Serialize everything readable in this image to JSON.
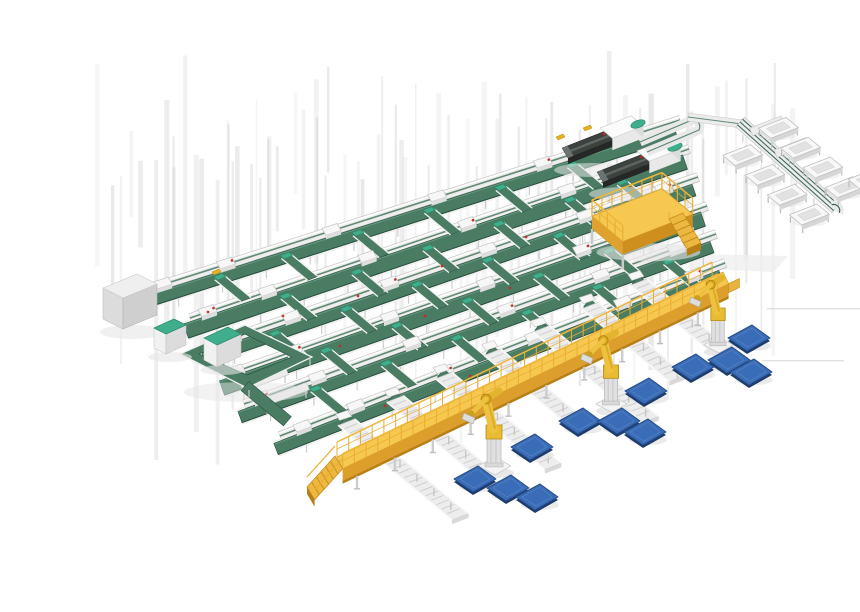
{
  "meta": {
    "description": "3D isometric render of an automated parcel sortation and palletizing system: grid of green belt sorter conveyors, two dark telescopic unloaders, a spur line with white trough bins, a yellow maintenance platform, an elevated yellow walkway with stairs, three yellow palletizing robots and scattered blue pallets.",
    "width": 860,
    "height": 580
  },
  "palette": {
    "bg": "#ffffff",
    "streak": "#cccccc",
    "streak_dark": "#bdbdbd",
    "frame": "#ececec",
    "frame_edge": "#c6c6c6",
    "frame_hi": "#ffffff",
    "frame_mid": "#dcdcdc",
    "leg": "#c2c2c2",
    "belt": "#4a7c64",
    "belt_dark": "#2e5947",
    "belt_line": "#49795f",
    "belt_hi": "#6a9a82",
    "teal": "#3fae8c",
    "teal_dark": "#2d8a6c",
    "machine_dark": "#3d423f",
    "machine_darker": "#242826",
    "machine_stripe": "#5d6663",
    "cabinet_top": "#efefef",
    "cabinet_front": "#dcdcdc",
    "cabinet_side": "#cfcfcf",
    "yellow": "#f6c84f",
    "yellow_mid": "#e0a22e",
    "yellow_dark": "#cf8f1f",
    "yellow_deep": "#b97f15",
    "rail": "#e9ac2f",
    "stair": "#edb83f",
    "robot": "#eec23f",
    "robot_dark": "#d9a51e",
    "robot_line": "#b68c15",
    "pedestal": "#e0e0e0",
    "pallet": "#3a6db8",
    "pallet_edge": "#274c88",
    "pallet_side": "#1d3c6e",
    "pallet_hi": "#5d86c2",
    "red": "#c9271b",
    "accent_yellow": "#e8b020",
    "shadow": "#e6e6e6",
    "white": "#f7f7f7"
  },
  "iso": {
    "u": [
      0.92,
      -0.36
    ],
    "v": [
      0.77,
      0.64
    ]
  },
  "streaks": {
    "x0": 58,
    "x1": 748,
    "count": 66,
    "y_top": 34,
    "extra_dark": 14
  },
  "grid": {
    "lanes": [
      {
        "s": [
          112,
          272
        ],
        "e": [
          640,
          104
        ]
      },
      {
        "s": [
          150,
          302
        ],
        "e": [
          649,
          133
        ]
      },
      {
        "s": [
          168,
          330
        ],
        "e": [
          658,
          161
        ]
      },
      {
        "s": [
          186,
          359
        ],
        "e": [
          667,
          190
        ]
      },
      {
        "s": [
          204,
          388
        ],
        "e": [
          676,
          218
        ]
      },
      {
        "s": [
          240,
          420
        ],
        "e": [
          685,
          247
        ]
      }
    ],
    "band_offset": [
      -4,
      13
    ],
    "machine_fracs": [
      0.14,
      0.34,
      0.54,
      0.74,
      0.9
    ],
    "branch_u": [
      [
        70,
        140,
        215,
        290,
        365,
        440
      ],
      [
        100,
        175,
        250,
        325,
        400,
        455
      ],
      [
        70,
        145,
        220,
        295,
        370,
        445
      ],
      [
        105,
        180,
        255,
        330,
        405,
        460
      ],
      [
        75,
        150,
        225,
        300,
        375,
        450
      ]
    ],
    "red_dots": [
      [
        168,
        296
      ],
      [
        243,
        300
      ],
      [
        318,
        280
      ],
      [
        402,
        250
      ],
      [
        486,
        221
      ],
      [
        214,
        357
      ],
      [
        300,
        330
      ],
      [
        385,
        300
      ],
      [
        470,
        272
      ],
      [
        345,
        390
      ],
      [
        430,
        360
      ],
      [
        515,
        330
      ]
    ],
    "yellow_marks": [
      [
        516,
        121
      ],
      [
        543,
        112
      ],
      [
        172,
        256
      ]
    ]
  },
  "stubs": [
    {
      "s": [
        202,
        372
      ],
      "e": [
        247,
        355
      ]
    },
    {
      "s": [
        225,
        386
      ],
      "e": [
        268,
        370
      ]
    }
  ],
  "loop": {
    "outer": [
      [
        140,
        338
      ],
      [
        205,
        309
      ],
      [
        272,
        341
      ],
      [
        207,
        372
      ]
    ],
    "inner": [
      [
        159,
        338
      ],
      [
        205,
        318
      ],
      [
        252,
        341
      ],
      [
        207,
        359
      ]
    ],
    "tail": {
      "from": [
        205,
        370
      ],
      "len": 55,
      "w": 12
    }
  },
  "cabinet": {
    "top": [
      [
        63,
        272
      ],
      [
        97,
        258
      ],
      [
        117,
        268
      ],
      [
        83,
        282
      ]
    ],
    "front": [
      [
        63,
        272
      ],
      [
        83,
        282
      ],
      [
        83,
        313
      ],
      [
        63,
        303
      ]
    ],
    "side": [
      [
        83,
        282
      ],
      [
        117,
        268
      ],
      [
        117,
        299
      ],
      [
        83,
        313
      ]
    ]
  },
  "tote_boxes": [
    {
      "top": [
        [
          114,
          312
        ],
        [
          134,
          303
        ],
        [
          146,
          309
        ],
        [
          126,
          318
        ]
      ],
      "front": [
        [
          114,
          312
        ],
        [
          126,
          318
        ],
        [
          126,
          338
        ],
        [
          114,
          332
        ]
      ],
      "side": [
        [
          126,
          318
        ],
        [
          146,
          309
        ],
        [
          146,
          329
        ],
        [
          126,
          338
        ]
      ]
    },
    {
      "top": [
        [
          164,
          322
        ],
        [
          188,
          311
        ],
        [
          201,
          318
        ],
        [
          177,
          329
        ]
      ],
      "front": [
        [
          164,
          322
        ],
        [
          177,
          329
        ],
        [
          177,
          351
        ],
        [
          164,
          344
        ]
      ],
      "side": [
        [
          177,
          329
        ],
        [
          201,
          318
        ],
        [
          201,
          340
        ],
        [
          177,
          351
        ]
      ]
    }
  ],
  "unloaders": [
    {
      "tip": [
        522,
        132
      ],
      "housing": [
        560,
        112
      ]
    },
    {
      "tip": [
        557,
        156
      ],
      "housing": [
        597,
        135
      ]
    }
  ],
  "hairpin": {
    "a": [
      600,
      126
    ],
    "b": [
      652,
      104
    ],
    "c": [
      659,
      114
    ],
    "d": [
      607,
      136
    ],
    "link_a": [
      648,
      101
    ],
    "link_b": [
      702,
      108
    ]
  },
  "bin_line": {
    "start": [
      700,
      106
    ],
    "dir": [
      0.74,
      0.66
    ],
    "len": 130,
    "width": 13,
    "bins_left": [
      36,
      66,
      96,
      126
    ],
    "left_off": -26,
    "bins_right": [
      22,
      52,
      82,
      112
    ],
    "right_off": 24,
    "extra_bins": [
      [
        828,
        163
      ],
      [
        845,
        186
      ]
    ],
    "spurs": [
      15,
      48
    ]
  },
  "platform": {
    "o": [
      552,
      200
    ],
    "ulen": 76,
    "vlen": 40,
    "deck_h": 13,
    "rail_h": 16,
    "leg_h": 15
  },
  "walkway": {
    "a": [
      297,
      441
    ],
    "b": [
      683,
      256
    ],
    "deck_w": 13,
    "deck_h": 12,
    "rail_h": 15,
    "post_step": 13,
    "leg_step": 42,
    "spur_s": [
      36,
      90,
      144,
      198,
      252,
      306,
      360
    ],
    "spur_front": [
      118,
      84,
      112,
      84,
      112,
      84,
      100
    ],
    "spur_back": 30,
    "spur_halfw": 9
  },
  "robots": [
    {
      "base": [
        454,
        449
      ],
      "scale": 1
    },
    {
      "base": [
        571,
        387
      ],
      "scale": 0.95
    },
    {
      "base": [
        678,
        328
      ],
      "scale": 0.9
    }
  ],
  "pallets": [
    [
      709,
      321
    ],
    [
      689,
      343
    ],
    [
      711,
      355
    ],
    [
      653,
      350
    ],
    [
      606,
      374
    ],
    [
      540,
      404
    ],
    [
      579,
      404
    ],
    [
      605,
      415
    ],
    [
      492,
      430
    ],
    [
      435,
      462
    ],
    [
      468,
      471
    ],
    [
      497,
      480
    ]
  ],
  "artifacts": {
    "hlines": [
      [
        727,
        292,
        133
      ],
      [
        722,
        344,
        82
      ]
    ],
    "shadow_quad": [
      [
        658,
        238
      ],
      [
        748,
        240
      ],
      [
        734,
        256
      ],
      [
        646,
        252
      ]
    ]
  }
}
